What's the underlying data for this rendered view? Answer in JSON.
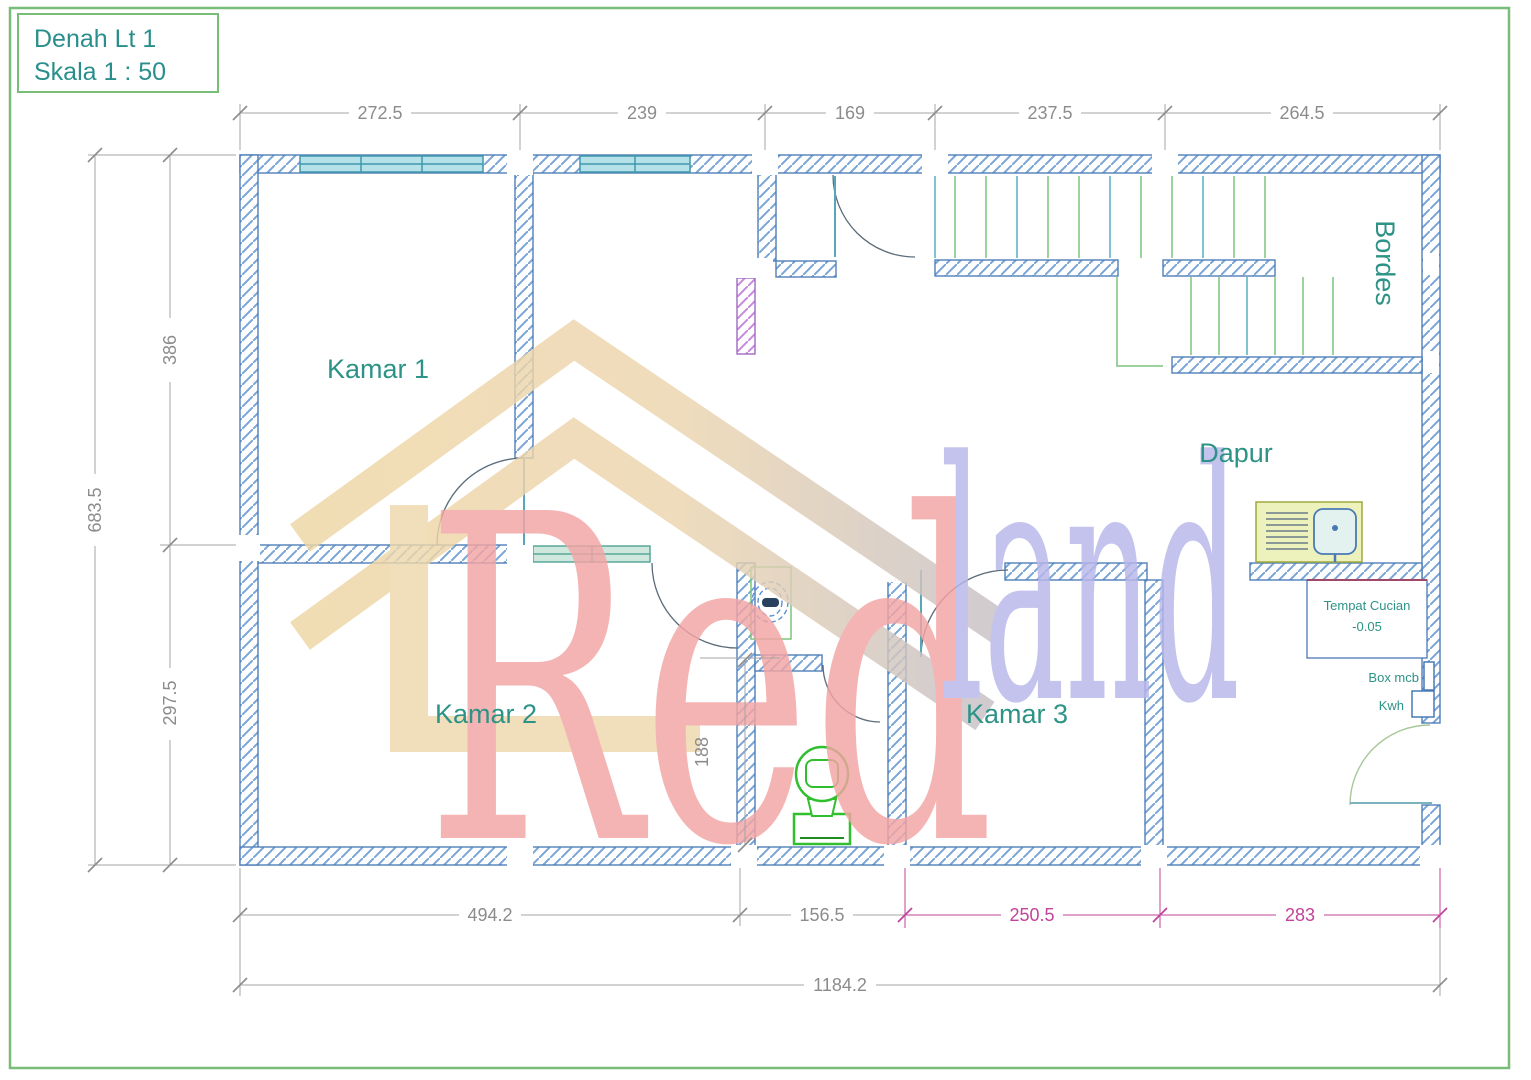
{
  "title_box": {
    "line1": "Denah Lt 1",
    "line2": "Skala 1 : 50"
  },
  "rooms": {
    "kamar1": "Kamar 1",
    "kamar2": "Kamar 2",
    "kamar3": "Kamar 3",
    "dapur": "Dapur",
    "bordes": "Bordes"
  },
  "fixtures": {
    "tempat_cucian_line1": "Tempat Cucian",
    "tempat_cucian_line2": "-0.05",
    "box_mcb": "Box mcb",
    "kwh": "Kwh"
  },
  "dimensions": {
    "top": [
      "272.5",
      "239",
      "169",
      "237.5",
      "264.5"
    ],
    "left_segments": [
      "386",
      "297.5"
    ],
    "left_total": "683.5",
    "bottom_gray": [
      "494.2",
      "156.5"
    ],
    "bottom_pink": [
      "250.5",
      "283"
    ],
    "bottom_total": "1184.2",
    "interior_188": "188"
  },
  "watermark": {
    "word1": "Red",
    "word2": "land"
  },
  "colors": {
    "wall_blue": "#4f7fb8",
    "window_cyan": "#b5e2e8",
    "teal_text": "#2e9387",
    "dim_gray": "#8c8c8c",
    "dim_pink": "#c2439b",
    "fixture_green": "#2fbf2f",
    "stair_green": "#7cc47c",
    "border_green": "#79bd79",
    "purple_wall": "#c789dd",
    "watermark_red": "#f4a4a4",
    "watermark_blue": "#b7b7ea",
    "watermark_tan": "#eed7ab"
  }
}
